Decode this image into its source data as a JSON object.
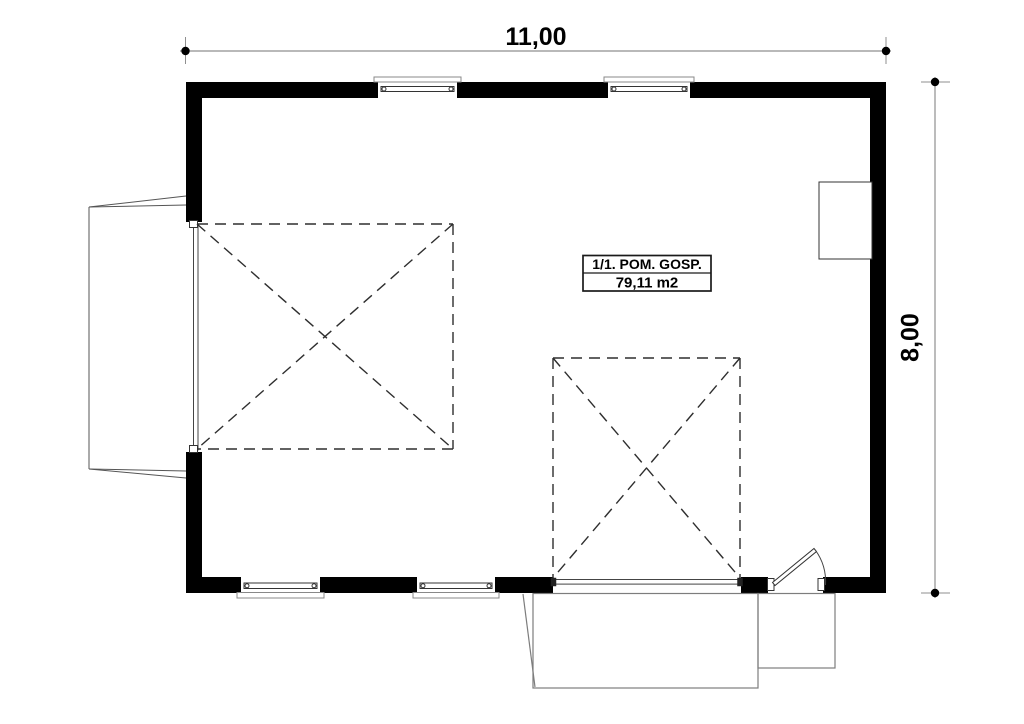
{
  "dimensions": {
    "top_label": "11,00",
    "right_label": "8,00"
  },
  "room": {
    "name": "1/1. POM. GOSP.",
    "area": "79,11 m2"
  },
  "colors": {
    "background": "#ffffff",
    "wall": "#000000",
    "dimension_line": "#8f8f8f",
    "dimension_marker": "#000000",
    "dashed_line": "#2e2e2e",
    "fixture_outline": "#444444",
    "door_panel_line": "#555555",
    "landing_line": "#7d7d7d",
    "label_box_border": "#1a1a1a"
  }
}
